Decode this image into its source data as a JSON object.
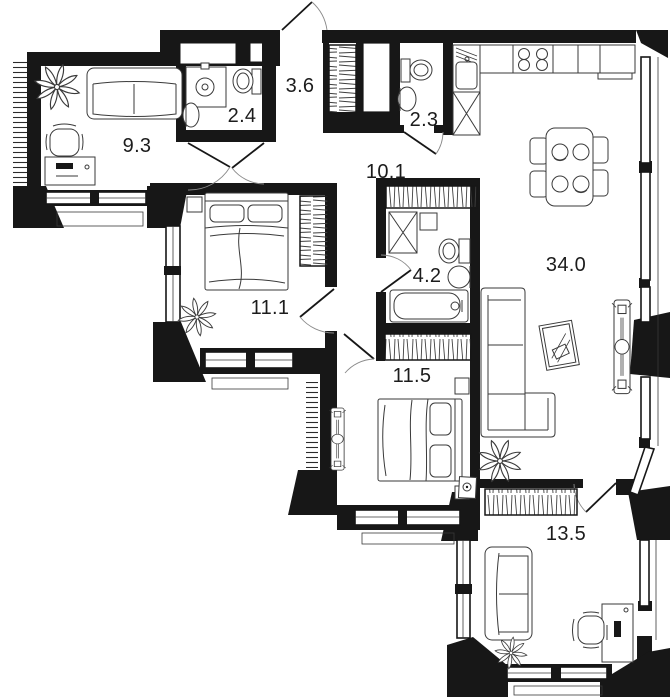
{
  "title": "apartment-floor-plan",
  "colors": {
    "wall": "#171717",
    "background": "#ffffff",
    "furniture_line": "#3a3a3a",
    "label_text": "#1c1c1c"
  },
  "rooms": [
    {
      "name": "study",
      "area": "9.3",
      "furniture": [
        "sofa",
        "desk",
        "office-chair",
        "plant"
      ]
    },
    {
      "name": "bathroom-small",
      "area": "2.4",
      "furniture": [
        "sink-cabinet",
        "toilet",
        "washbasin"
      ]
    },
    {
      "name": "entry-hall",
      "area": "3.6",
      "furniture": [
        "entry-door",
        "wardrobe",
        "closet"
      ]
    },
    {
      "name": "wc",
      "area": "2.3",
      "furniture": [
        "toilet",
        "washbasin"
      ]
    },
    {
      "name": "hallway",
      "area": "10.1",
      "furniture": [
        "wardrobe"
      ]
    },
    {
      "name": "bedroom-1",
      "area": "11.1",
      "furniture": [
        "double-bed",
        "wardrobe",
        "nightstand",
        "plant"
      ]
    },
    {
      "name": "bathroom",
      "area": "4.2",
      "furniture": [
        "washing-machine",
        "water-heater",
        "toilet",
        "washbasin",
        "bathtub"
      ]
    },
    {
      "name": "living-room-kitchen",
      "area": "34.0",
      "furniture": [
        "kitchen-counter",
        "stove",
        "kitchen-sink",
        "dining-table",
        "four-chairs",
        "corner-sofa",
        "mirror",
        "plant",
        "convector"
      ]
    },
    {
      "name": "bedroom-2",
      "area": "11.5",
      "furniture": [
        "double-bed",
        "wardrobe",
        "nightstand",
        "convector",
        "tv-stand"
      ]
    },
    {
      "name": "bedroom-3",
      "area": "13.5",
      "furniture": [
        "sofa",
        "desk",
        "office-chair",
        "wardrobe",
        "plant"
      ]
    }
  ]
}
